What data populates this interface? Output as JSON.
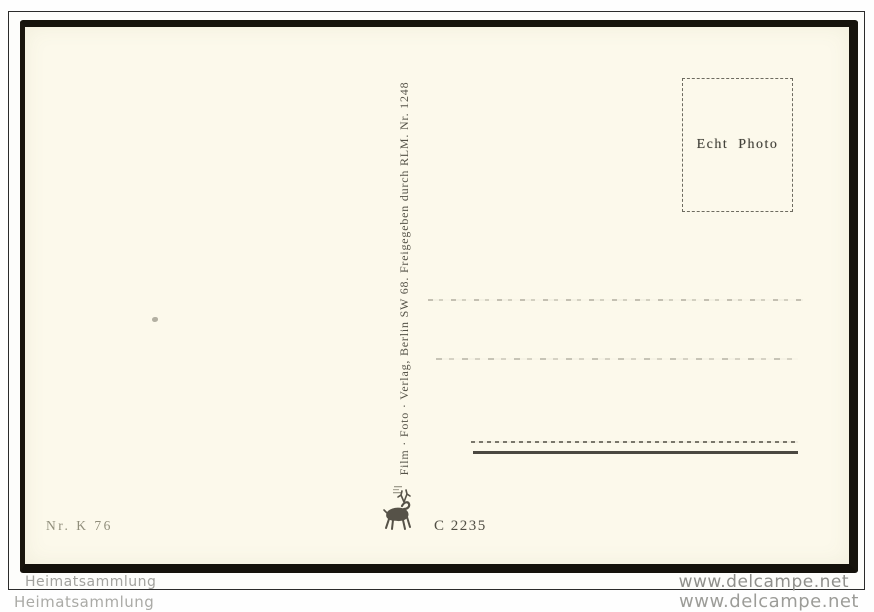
{
  "scan": {
    "background_color": "#fefefe",
    "frame_color": "#2b2b2b",
    "card_paper_color": "#fcf9eb",
    "card_edge_color": "#16130c"
  },
  "stamp_box": {
    "label": "Echt Photo"
  },
  "publisher": {
    "vertical_text": "Film · Foto · Verlag, Berlin SW 68. Freigegeben durch RLM. Nr. 1248",
    "logo_icon": "deer-logo",
    "order_code": "C 2235"
  },
  "card_number": "Nr. K 76",
  "watermarks": {
    "collection_inner": "Heimatsammlung",
    "collection_outer": "Heimatsammlung",
    "site_inner": "www.delcampe.net",
    "site_outer": "www.delcampe.net",
    "color": "#9c9c98"
  }
}
